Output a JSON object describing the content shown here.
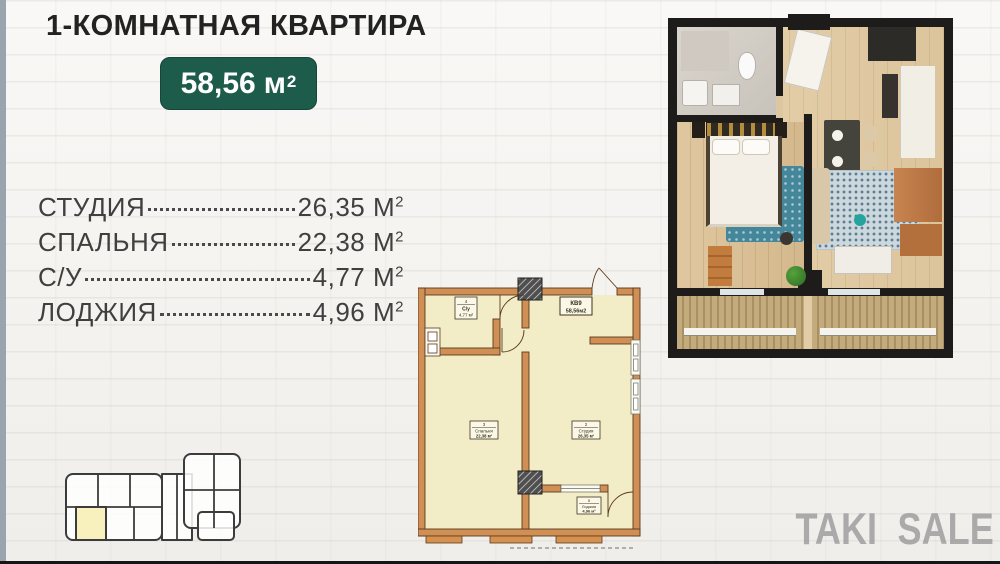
{
  "header": {
    "title": "1-КОМНАТНАЯ КВАРТИРА",
    "badge": {
      "value": "58,56",
      "unit": "м",
      "sup": "2"
    }
  },
  "room_list": {
    "unit": "М",
    "sup": "2",
    "rows": [
      {
        "label": "СТУДИЯ",
        "value": "26,35"
      },
      {
        "label": "СПАЛЬНЯ",
        "value": "22,38"
      },
      {
        "label": "С/У",
        "value": "4,77"
      },
      {
        "label": "ЛОДЖИЯ",
        "value": "4,96"
      }
    ]
  },
  "floor_plan": {
    "apartment": {
      "number": "КВ9",
      "area": "58,56м2"
    },
    "rooms": [
      {
        "num": "4",
        "name": "С/у",
        "area": "4,77 м²"
      },
      {
        "num": "3",
        "name": "Спальня",
        "area": "22,38 м²"
      },
      {
        "num": "2",
        "name": "Студия",
        "area": "26,35 м²"
      },
      {
        "num": "5",
        "name": "Лоджия",
        "area": "4,96 м²"
      }
    ]
  },
  "brand": {
    "left": "TAKI",
    "right": "SALE"
  },
  "icons": {
    "logo_icon": "handshake-icon"
  },
  "colors": {
    "accent_green": "#1d5b4b",
    "plan_wall_tan": "#cf8f55",
    "plan_floor_cream": "#f2edc6",
    "keyplan_highlight": "#f8f0bd",
    "logo_gray": "#9c9c9c"
  }
}
